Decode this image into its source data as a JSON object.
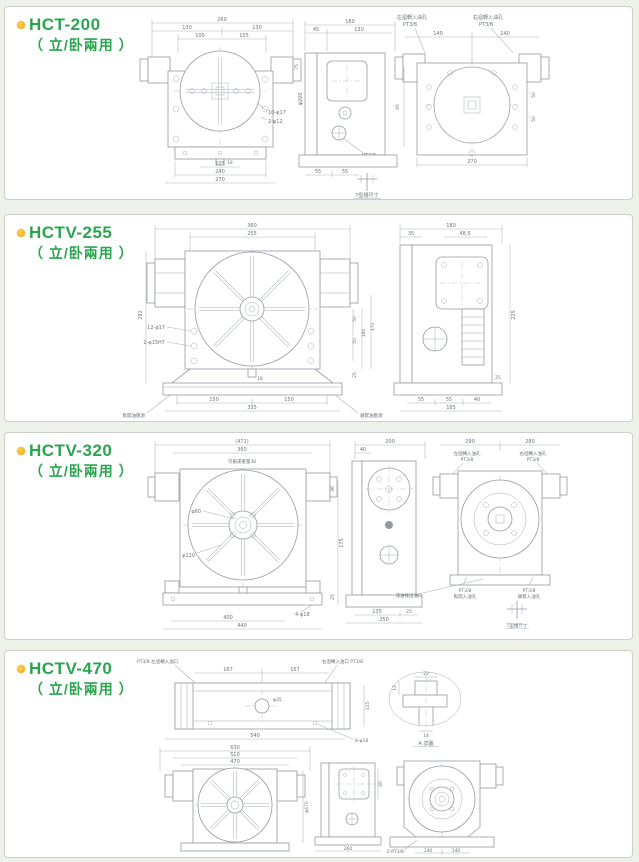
{
  "page": {
    "bg_color": "#eef0ea",
    "panel_bg": "#ffffff",
    "panel_border": "#ccd0c9",
    "accent_green": "#2aa44e",
    "bullet_color": "#f0a312",
    "drawing_line_color": "#949aa1"
  },
  "panels": [
    {
      "title": "HCT-200",
      "subtitle": "（ 立/卧兩用 ）",
      "front": {
        "d260": "260",
        "d130L": "130",
        "d130R": "130",
        "d105L": "105",
        "d105R": "105",
        "d105b": "105",
        "d240": "240",
        "d270": "270",
        "d18": "18",
        "c_holes": "10-φ17",
        "c_pins": "2-φ12",
        "dphi200": "φ200",
        "d75": "75"
      },
      "side": {
        "d180": "180",
        "d45": "45",
        "d130": "130",
        "d55L": "55",
        "d55R": "55",
        "port_line1": "PT3/8",
        "port_line2": "鬆開入油孔",
        "tslot": "T型槽尺寸"
      },
      "rear": {
        "cL1": "左迴轉入油孔",
        "cL2": "PT3/8",
        "cR1": "右迴轉入油孔",
        "cR2": "PT3/8",
        "d140L": "140",
        "d140R": "140",
        "d270": "270",
        "d95": "95",
        "d50a": "50",
        "d50b": "50"
      }
    },
    {
      "title": "HCTV-255",
      "subtitle": "（ 立/卧兩用 ）",
      "front": {
        "d360": "360",
        "d255": "255",
        "d292": "292",
        "c_holes": "12-φ17",
        "c_pins": "2-φ15H7",
        "d18": "18",
        "d150L": "150",
        "d150R": "150",
        "d335": "335",
        "d50a": "50",
        "d50b": "50",
        "d160": "160",
        "d170": "170",
        "d25": "25",
        "lbl_unclamp": "鬆開油壓源",
        "lbl_clamp": "鎖緊油壓源"
      },
      "side": {
        "d180": "180",
        "d35": "35",
        "d485": "48.5",
        "d225": "225",
        "d55a": "55",
        "d55b": "55",
        "d40": "40",
        "d165": "165",
        "d25": "25"
      }
    },
    {
      "title": "HCTV-320",
      "subtitle": "（ 立/卧兩用 ）",
      "front": {
        "d471": "(471)",
        "d360": "360",
        "c_note": "可搬運重量30",
        "dphi60": "φ60",
        "dphi120": "φ120",
        "d400": "400",
        "d440": "440",
        "c_holes": "4-φ18",
        "d175": "175",
        "d36": "36",
        "d25": "25"
      },
      "side": {
        "d200": "200",
        "d40": "40",
        "d135": "135",
        "d25": "25",
        "d250": "250"
      },
      "rear": {
        "d290": "290",
        "d280": "280",
        "cL1": "左迴轉入油孔",
        "cL2": "PT3/8",
        "cR1": "右迴轉入油孔",
        "cR2": "PT3/8",
        "pL1": "PT3/8",
        "pL2": "鬆開入油孔",
        "pR1": "PT3/8",
        "pR2": "鎖緊入油孔",
        "drain": "洩油排出油口",
        "tslot": "T型槽尺寸"
      }
    },
    {
      "title": "HCTV-470",
      "subtitle": "（ 立/卧兩用 ）",
      "top": {
        "cL": "PT3/8 左迴轉入油口",
        "cR": "右迴轉入油口 PT3/8",
        "d167L": "167",
        "d167R": "167",
        "d540": "540",
        "d115": "115",
        "dphi35": "φ35",
        "c_holes": "8-φ18"
      },
      "detail": {
        "d22": "22",
        "d14": "14",
        "d12": "12",
        "label": "A 詳圖"
      },
      "front": {
        "d630": "630",
        "d510": "510",
        "d470": "470",
        "dphi470": "φ470"
      },
      "side": {
        "d260": "260",
        "d40": "40"
      },
      "rear": {
        "d140L": "140",
        "d140R": "140",
        "c_ports": "2-PT3/8"
      }
    }
  ]
}
